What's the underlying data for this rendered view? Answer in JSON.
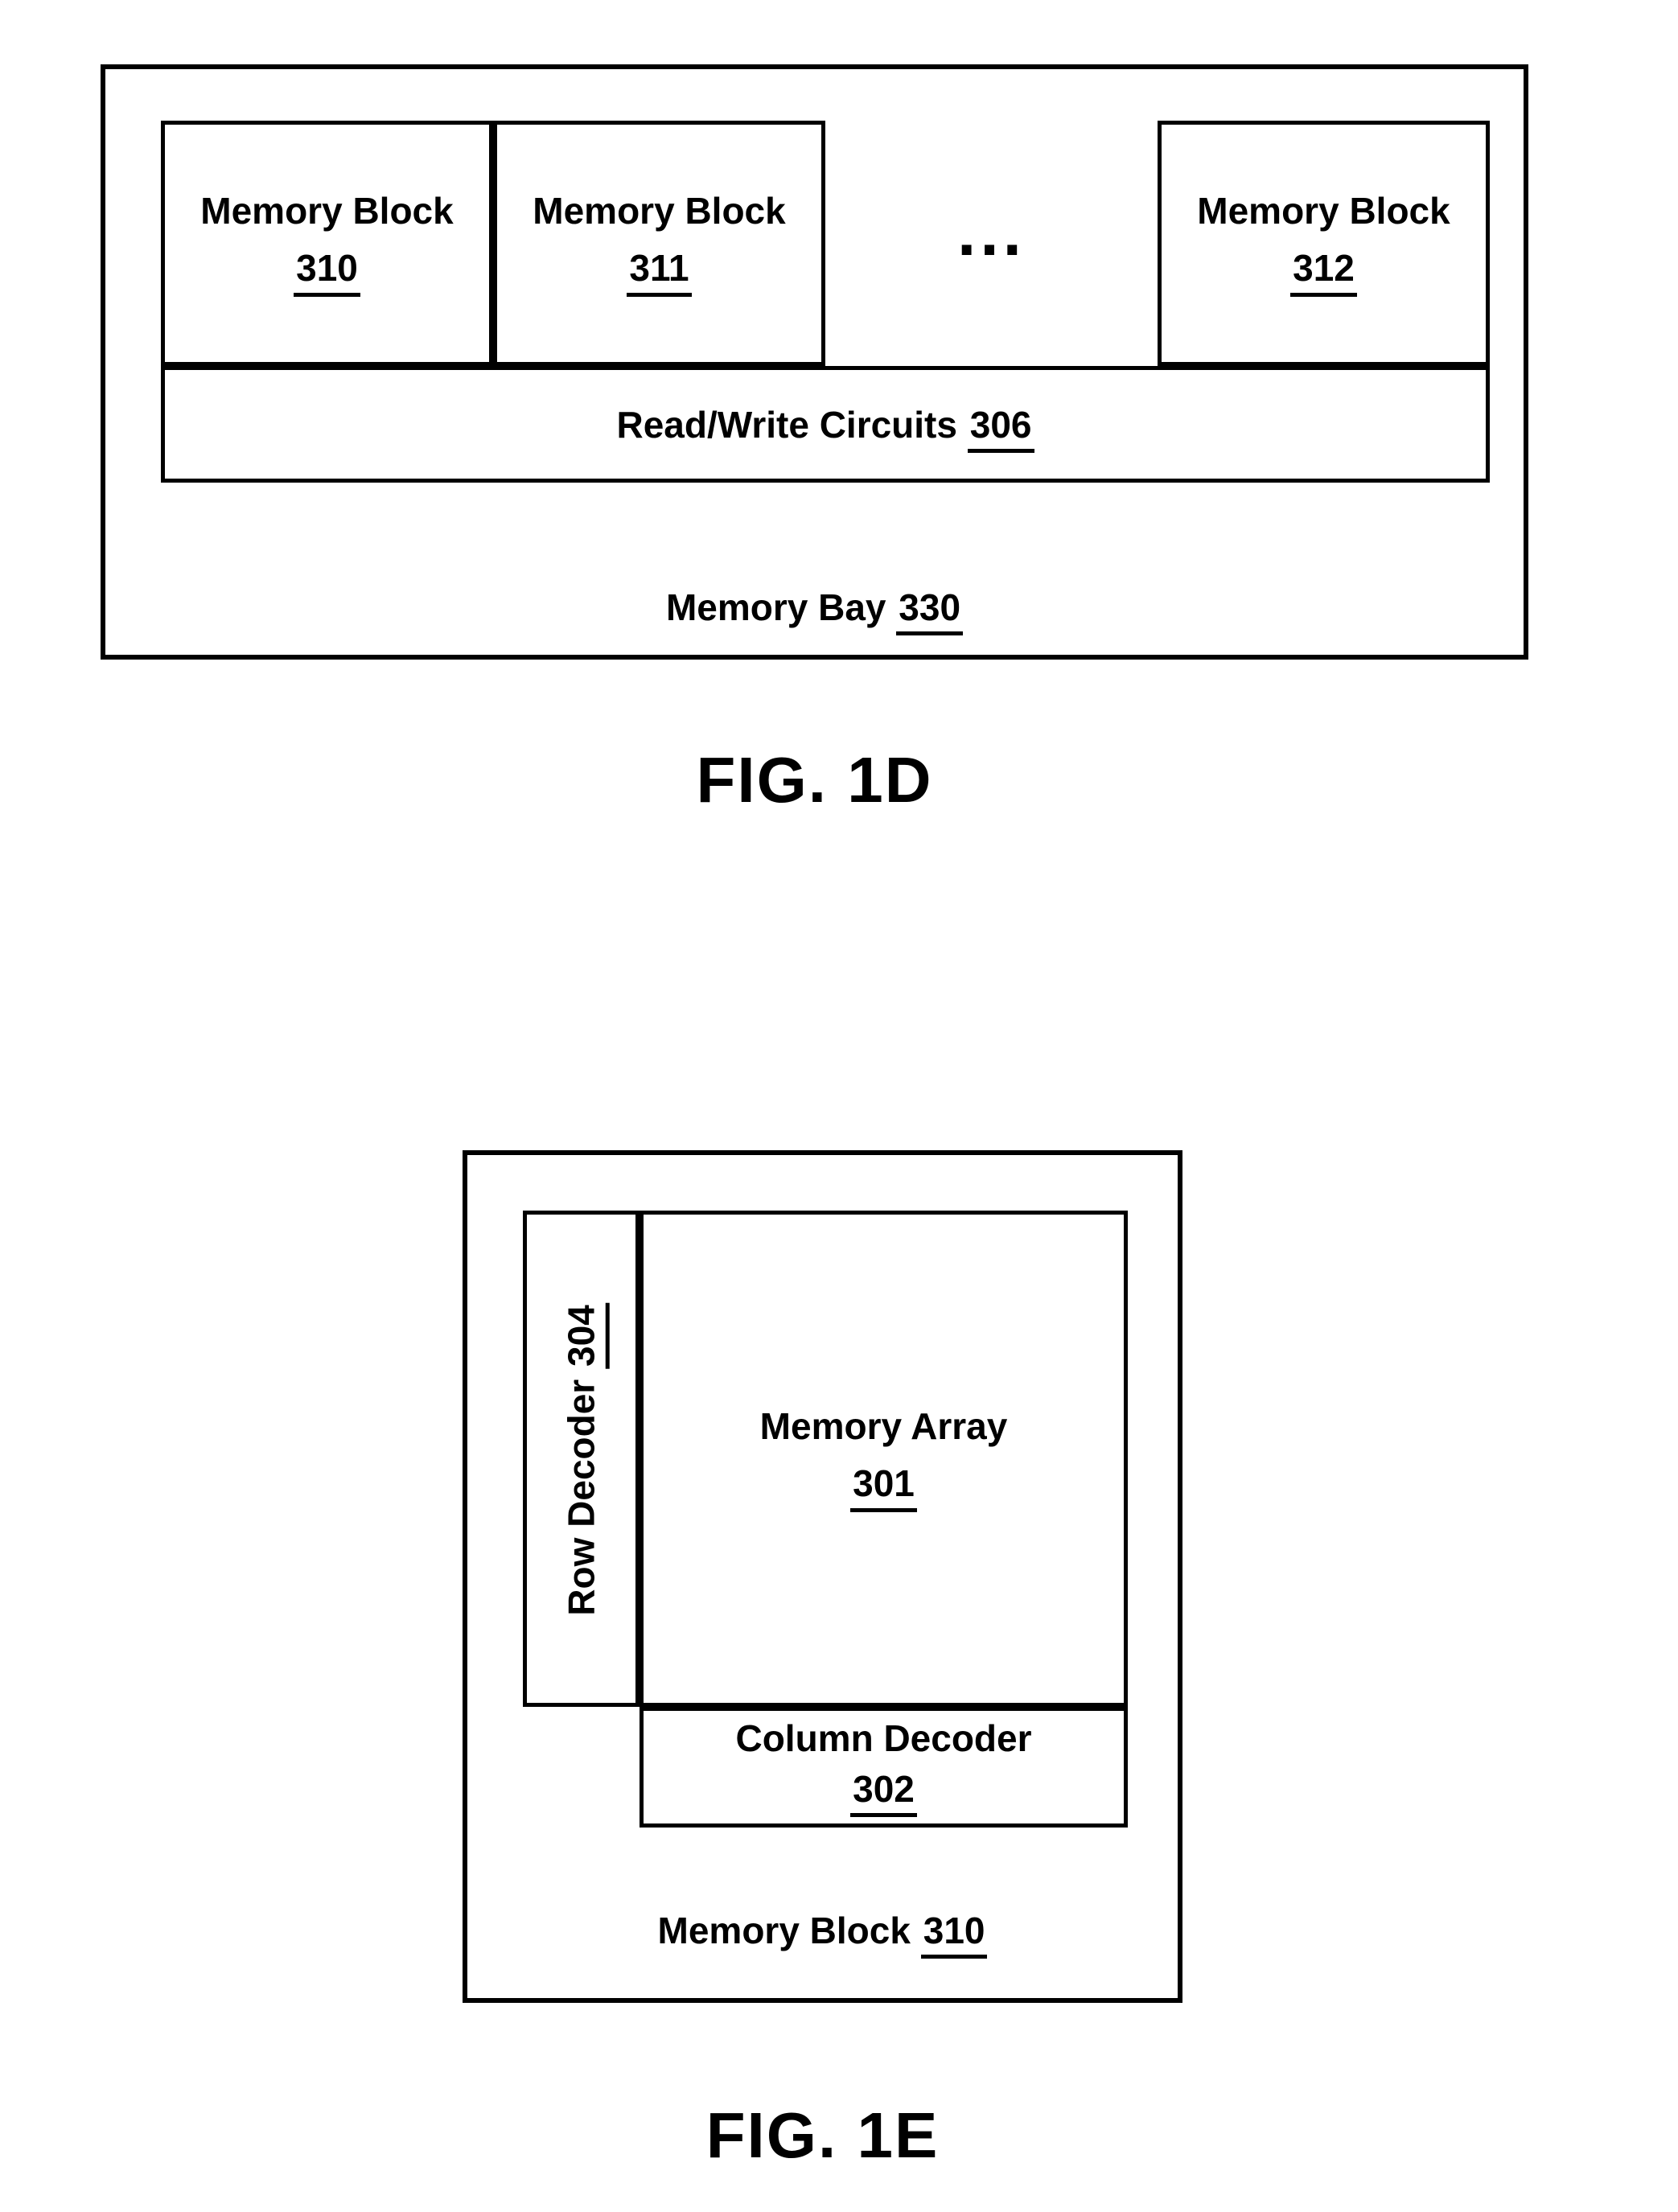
{
  "colors": {
    "line": "#000000",
    "background": "#ffffff",
    "text": "#000000"
  },
  "fig_1d": {
    "caption": "FIG. 1D",
    "memory_blocks": [
      {
        "label": "Memory Block",
        "ref": "310"
      },
      {
        "label": "Memory Block",
        "ref": "311"
      },
      {
        "label": "Memory Block",
        "ref": "312"
      }
    ],
    "ellipsis": "...",
    "read_write_circuits": {
      "label": "Read/Write Circuits",
      "ref": "306"
    },
    "memory_bay": {
      "label": "Memory Bay",
      "ref": "330"
    }
  },
  "fig_1e": {
    "caption": "FIG. 1E",
    "row_decoder": {
      "label": "Row Decoder",
      "ref": "304"
    },
    "memory_array": {
      "label": "Memory Array",
      "ref": "301"
    },
    "column_decoder": {
      "label": "Column Decoder",
      "ref": "302"
    },
    "memory_block": {
      "label": "Memory Block",
      "ref": "310"
    }
  }
}
